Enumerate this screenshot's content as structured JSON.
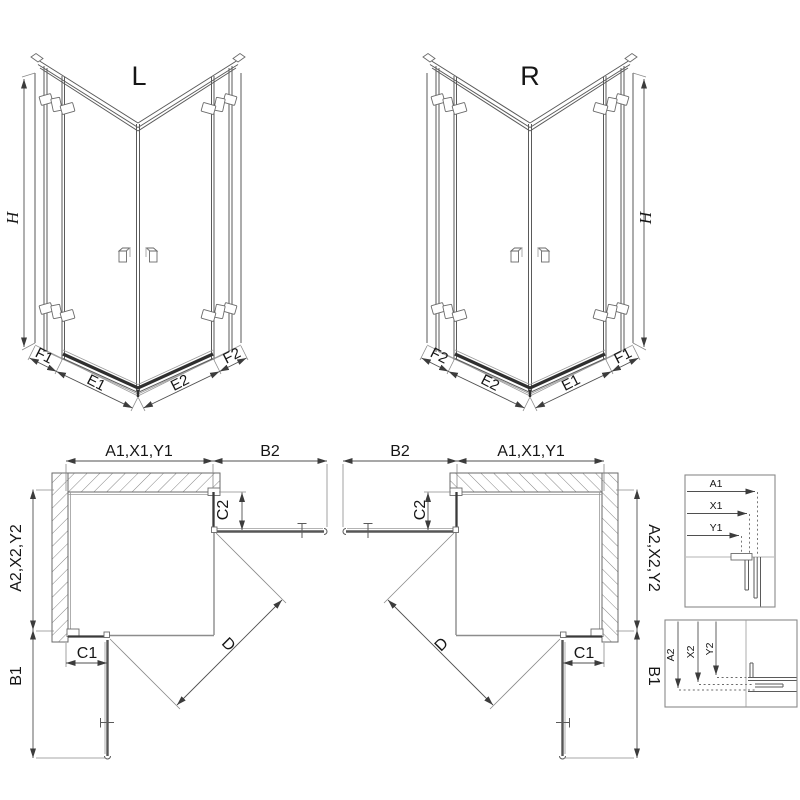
{
  "page": {
    "background": "#ffffff",
    "line_color": "#5a5a5a",
    "dark_line_color": "#2f2f2f",
    "hatch_color": "#858585",
    "text_color": "#161616"
  },
  "iso_left": {
    "title": "L",
    "height_dim": "H",
    "bottom_dims": [
      "F1",
      "E1",
      "E2",
      "F2"
    ]
  },
  "iso_right": {
    "title": "R",
    "height_dim": "H",
    "bottom_dims": [
      "F2",
      "E2",
      "E1",
      "F1"
    ]
  },
  "plan_left": {
    "width_dim": "A1,X1,Y1",
    "door_open_dim_top": "B2",
    "depth_dim": "A2,X2,Y2",
    "fixed_panel_dim_top": "C2",
    "fixed_panel_dim_bottom": "C1",
    "door_open_dim_side": "B1",
    "diagonal_dim": "D"
  },
  "plan_right": {
    "width_dim": "A1,X1,Y1",
    "door_open_dim_top": "B2",
    "depth_dim": "A2,X2,Y2",
    "fixed_panel_dim_top": "C2",
    "fixed_panel_dim_bottom": "C1",
    "door_open_dim_side": "B1",
    "diagonal_dim": "D"
  },
  "detail_width": {
    "dims": [
      "A1",
      "X1",
      "Y1"
    ]
  },
  "detail_depth": {
    "dims": [
      "A2",
      "X2",
      "Y2"
    ]
  }
}
